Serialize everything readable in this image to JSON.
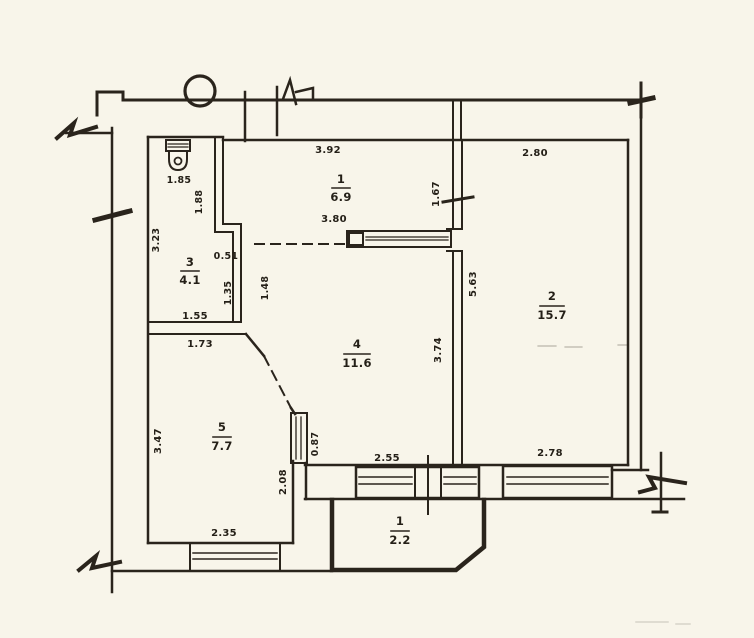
{
  "plan": {
    "title": "apartment floor plan (scanned)",
    "paper_color": "#f8f5ea",
    "ink_color": "#2a241c",
    "rooms": [
      {
        "number": "1",
        "area": "6.9"
      },
      {
        "number": "2",
        "area": "15.7"
      },
      {
        "number": "3",
        "area": "4.1"
      },
      {
        "number": "4",
        "area": "11.6"
      },
      {
        "number": "5",
        "area": "7.7"
      },
      {
        "number": "1",
        "area": "2.2"
      }
    ],
    "dims": {
      "toilet_width": "1.85",
      "room1_top": "3.92",
      "room1_bottom": "3.80",
      "room1_right": "1.67",
      "room2_top": "2.80",
      "room2_left": "5.63",
      "room2_bottom": "2.78",
      "room3_left": "3.23",
      "room3_right_upper": "1.88",
      "room3_step": "0.51",
      "room3_right_lower": "1.35",
      "room3_bottom": "1.55",
      "room4_left": "1.48",
      "room4_right": "3.74",
      "room4_bottom": "2.55",
      "room4_west_window": "0.87",
      "room5_top": "1.73",
      "room5_left": "3.47",
      "room5_right": "2.08",
      "room5_bottom": "2.35"
    },
    "icons": {
      "toilet": "toilet-icon",
      "duct_circle": "duct-circle-icon",
      "wall_break": "wall-break-icon"
    }
  }
}
